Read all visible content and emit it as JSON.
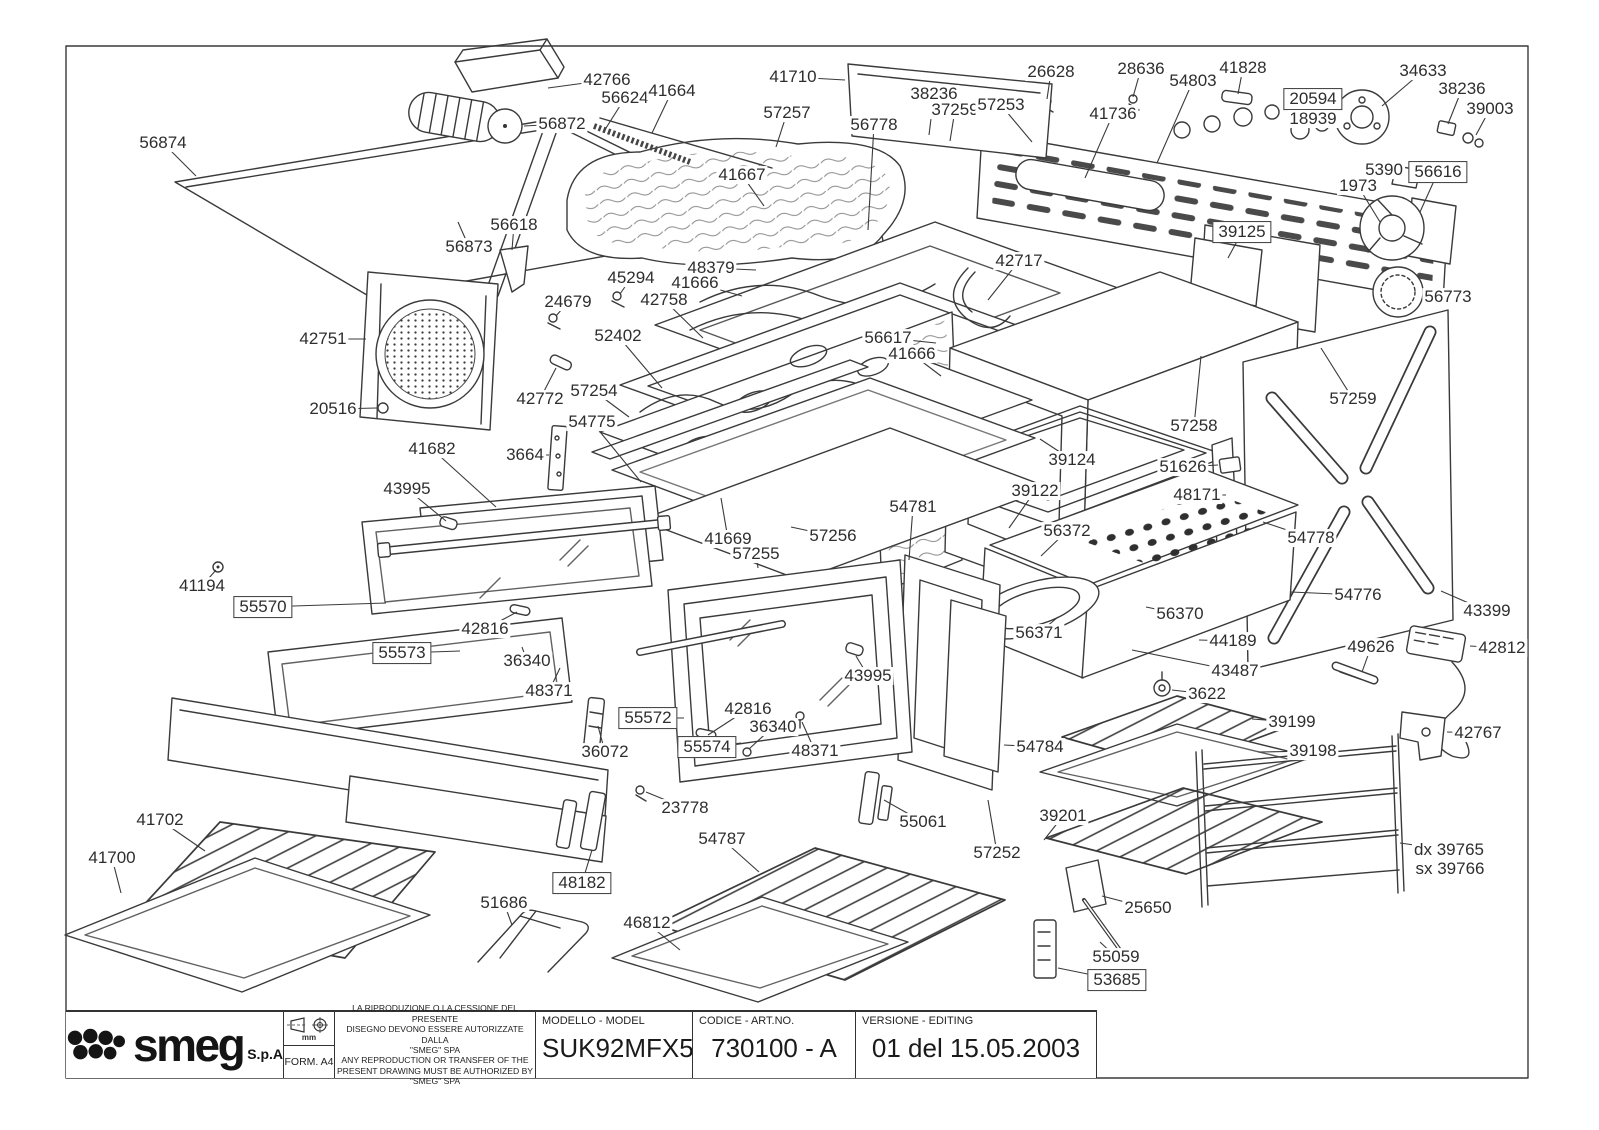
{
  "document": {
    "kind": "exploded parts diagram",
    "product": "oven"
  },
  "title_block": {
    "manufacturer": "smeg",
    "company_suffix": "S.p.A",
    "units_label": "mm",
    "form_label": "FORM. A4",
    "legal_lines": [
      "LA RIPRODUZIONE O LA CESSIONE DEL PRESENTE",
      "DISEGNO DEVONO ESSERE AUTORIZZATE DALLA",
      "\"SMEG\" SPA",
      "ANY REPRODUCTION OR TRANSFER OF THE",
      "PRESENT DRAWING MUST BE AUTHORIZED BY",
      "\"SMEG\" SPA"
    ],
    "model": {
      "label": "MODELLO - MODEL",
      "value": "SUK92MFX5"
    },
    "code": {
      "label": "CODICE - ART.NO.",
      "value": "730100 - A"
    },
    "version": {
      "label": "VERSIONE - EDITING",
      "value": "01 del 15.05.2003"
    }
  },
  "line_color": "#3a3a3a",
  "labels": [
    {
      "text": "42766",
      "x": 607,
      "y": 80,
      "l": [
        548,
        88
      ]
    },
    {
      "text": "56624",
      "x": 625,
      "y": 98,
      "l": [
        606,
        128
      ]
    },
    {
      "text": "41664",
      "x": 672,
      "y": 91,
      "l": [
        652,
        133
      ]
    },
    {
      "text": "56872",
      "x": 562,
      "y": 124,
      "l": [
        524,
        126
      ]
    },
    {
      "text": "56874",
      "x": 163,
      "y": 143,
      "l": [
        196,
        176
      ]
    },
    {
      "text": "56873",
      "x": 469,
      "y": 247,
      "l": [
        458,
        222
      ]
    },
    {
      "text": "56618",
      "x": 514,
      "y": 225,
      "l": [
        512,
        250
      ]
    },
    {
      "text": "41710",
      "x": 793,
      "y": 77,
      "l": [
        845,
        80
      ]
    },
    {
      "text": "57257",
      "x": 787,
      "y": 113,
      "l": [
        776,
        147
      ]
    },
    {
      "text": "41667",
      "x": 742,
      "y": 175,
      "l": [
        764,
        206
      ]
    },
    {
      "text": "56778",
      "x": 874,
      "y": 125,
      "l": [
        868,
        230
      ]
    },
    {
      "text": "38236",
      "x": 934,
      "y": 94,
      "l": [
        929,
        135
      ]
    },
    {
      "text": "37259",
      "x": 955,
      "y": 110,
      "l": [
        950,
        141
      ]
    },
    {
      "text": "57253",
      "x": 1001,
      "y": 105,
      "l": [
        1032,
        142
      ]
    },
    {
      "text": "26628",
      "x": 1051,
      "y": 72,
      "l": [
        1047,
        99
      ]
    },
    {
      "text": "28636",
      "x": 1141,
      "y": 69,
      "l": [
        1133,
        97
      ]
    },
    {
      "text": "54803",
      "x": 1193,
      "y": 81,
      "l": [
        1157,
        163
      ]
    },
    {
      "text": "41828",
      "x": 1243,
      "y": 68,
      "l": [
        1238,
        94
      ]
    },
    {
      "text": "41736",
      "x": 1113,
      "y": 114,
      "l": [
        1085,
        178
      ]
    },
    {
      "text": "34633",
      "x": 1423,
      "y": 71,
      "l": [
        1382,
        106
      ]
    },
    {
      "text": "20594",
      "x": 1313,
      "y": 99,
      "boxed": true,
      "l": [
        1303,
        125
      ]
    },
    {
      "text": "18939",
      "x": 1313,
      "y": 119
    },
    {
      "text": "38236",
      "x": 1462,
      "y": 89,
      "l": [
        1448,
        124
      ]
    },
    {
      "text": "39003",
      "x": 1490,
      "y": 109,
      "l": [
        1476,
        135
      ]
    },
    {
      "text": "5390",
      "x": 1384,
      "y": 170,
      "l": [
        1404,
        172
      ]
    },
    {
      "text": "56616",
      "x": 1438,
      "y": 172,
      "boxed": true,
      "l": [
        1420,
        212
      ]
    },
    {
      "text": "1973",
      "x": 1358,
      "y": 186,
      "l": [
        1380,
        222
      ]
    },
    {
      "text": "39125",
      "x": 1242,
      "y": 232,
      "boxed": true,
      "l": [
        1228,
        258
      ]
    },
    {
      "text": "56773",
      "x": 1448,
      "y": 297,
      "l": [
        1423,
        293
      ]
    },
    {
      "text": "42717",
      "x": 1019,
      "y": 261,
      "l": [
        988,
        300
      ]
    },
    {
      "text": "48379",
      "x": 711,
      "y": 268,
      "l": [
        756,
        270
      ]
    },
    {
      "text": "41666",
      "x": 695,
      "y": 283,
      "l": [
        742,
        296
      ]
    },
    {
      "text": "45294",
      "x": 631,
      "y": 278,
      "l": [
        620,
        294
      ]
    },
    {
      "text": "42758",
      "x": 664,
      "y": 300,
      "l": [
        703,
        338
      ]
    },
    {
      "text": "24679",
      "x": 568,
      "y": 302,
      "l": [
        556,
        316
      ]
    },
    {
      "text": "52402",
      "x": 618,
      "y": 336,
      "l": [
        662,
        388
      ]
    },
    {
      "text": "42751",
      "x": 323,
      "y": 339,
      "l": [
        366,
        339
      ]
    },
    {
      "text": "20516",
      "x": 333,
      "y": 409,
      "l": [
        377,
        408
      ]
    },
    {
      "text": "42772",
      "x": 540,
      "y": 399,
      "l": [
        556,
        368
      ]
    },
    {
      "text": "57254",
      "x": 594,
      "y": 391,
      "l": [
        629,
        417
      ]
    },
    {
      "text": "54775",
      "x": 592,
      "y": 422,
      "l": [
        641,
        482
      ]
    },
    {
      "text": "3664",
      "x": 525,
      "y": 455,
      "l": [
        549,
        455
      ]
    },
    {
      "text": "41682",
      "x": 432,
      "y": 449,
      "l": [
        496,
        507
      ]
    },
    {
      "text": "43995",
      "x": 407,
      "y": 489,
      "l": [
        446,
        521
      ]
    },
    {
      "text": "41194",
      "x": 202,
      "y": 586,
      "l": [
        216,
        570
      ]
    },
    {
      "text": "55570",
      "x": 263,
      "y": 607,
      "boxed": true,
      "l": [
        386,
        603
      ]
    },
    {
      "text": "42816",
      "x": 485,
      "y": 629,
      "l": [
        517,
        612
      ]
    },
    {
      "text": "55573",
      "x": 402,
      "y": 653,
      "boxed": true,
      "l": [
        460,
        651
      ]
    },
    {
      "text": "36340",
      "x": 527,
      "y": 661,
      "l": [
        522,
        647
      ]
    },
    {
      "text": "48371",
      "x": 549,
      "y": 691,
      "l": [
        560,
        668
      ]
    },
    {
      "text": "56617",
      "x": 888,
      "y": 338,
      "l": [
        936,
        343
      ]
    },
    {
      "text": "41666",
      "x": 912,
      "y": 354,
      "l": [
        941,
        376
      ]
    },
    {
      "text": "39124",
      "x": 1072,
      "y": 460,
      "l": [
        1040,
        439
      ]
    },
    {
      "text": "57258",
      "x": 1194,
      "y": 426,
      "l": [
        1201,
        356
      ]
    },
    {
      "text": "51626",
      "x": 1183,
      "y": 467,
      "l": [
        1218,
        465
      ]
    },
    {
      "text": "48171",
      "x": 1197,
      "y": 495,
      "l": [
        1226,
        495
      ]
    },
    {
      "text": "57259",
      "x": 1353,
      "y": 399,
      "l": [
        1321,
        348
      ]
    },
    {
      "text": "54778",
      "x": 1311,
      "y": 538,
      "l": [
        1263,
        522
      ]
    },
    {
      "text": "54776",
      "x": 1358,
      "y": 595,
      "l": [
        1291,
        592
      ]
    },
    {
      "text": "43399",
      "x": 1487,
      "y": 611,
      "l": [
        1441,
        591
      ]
    },
    {
      "text": "41669",
      "x": 728,
      "y": 539,
      "l": [
        721,
        498
      ]
    },
    {
      "text": "57256",
      "x": 833,
      "y": 536,
      "l": [
        791,
        527
      ]
    },
    {
      "text": "57255",
      "x": 756,
      "y": 554,
      "l": [
        758,
        568
      ]
    },
    {
      "text": "54781",
      "x": 913,
      "y": 507,
      "l": [
        909,
        560
      ]
    },
    {
      "text": "39122",
      "x": 1035,
      "y": 491,
      "l": [
        1009,
        528
      ]
    },
    {
      "text": "56372",
      "x": 1067,
      "y": 531,
      "l": [
        1041,
        556
      ]
    },
    {
      "text": "56370",
      "x": 1180,
      "y": 614,
      "l": [
        1146,
        607
      ]
    },
    {
      "text": "56371",
      "x": 1039,
      "y": 633,
      "l": [
        1058,
        617
      ]
    },
    {
      "text": "44189",
      "x": 1233,
      "y": 641,
      "l": [
        1199,
        640
      ]
    },
    {
      "text": "43487",
      "x": 1235,
      "y": 671,
      "l": [
        1132,
        650
      ]
    },
    {
      "text": "3622",
      "x": 1207,
      "y": 694,
      "l": [
        1172,
        690
      ]
    },
    {
      "text": "49626",
      "x": 1371,
      "y": 647,
      "l": [
        1362,
        672
      ]
    },
    {
      "text": "42812",
      "x": 1502,
      "y": 648,
      "l": [
        1470,
        646
      ]
    },
    {
      "text": "42767",
      "x": 1478,
      "y": 733,
      "l": [
        1447,
        732
      ]
    },
    {
      "text": "39199",
      "x": 1292,
      "y": 722,
      "l": [
        1252,
        719
      ]
    },
    {
      "text": "39198",
      "x": 1313,
      "y": 751,
      "l": [
        1258,
        752
      ]
    },
    {
      "text": "54784",
      "x": 1040,
      "y": 747,
      "l": [
        1004,
        745
      ]
    },
    {
      "text": "36072",
      "x": 605,
      "y": 752,
      "l": [
        598,
        726
      ]
    },
    {
      "text": "55572",
      "x": 648,
      "y": 718,
      "boxed": true,
      "l": [
        684,
        718
      ]
    },
    {
      "text": "42816",
      "x": 748,
      "y": 709,
      "l": [
        708,
        735
      ]
    },
    {
      "text": "36340",
      "x": 773,
      "y": 727,
      "l": [
        749,
        749
      ]
    },
    {
      "text": "55574",
      "x": 707,
      "y": 747,
      "boxed": true,
      "l": [
        741,
        743
      ]
    },
    {
      "text": "48371",
      "x": 815,
      "y": 751,
      "l": [
        802,
        722
      ]
    },
    {
      "text": "43995",
      "x": 868,
      "y": 676,
      "l": [
        856,
        656
      ]
    },
    {
      "text": "23778",
      "x": 685,
      "y": 808,
      "l": [
        646,
        792
      ]
    },
    {
      "text": "48182",
      "x": 582,
      "y": 883,
      "boxed": true,
      "l": [
        592,
        850
      ]
    },
    {
      "text": "41702",
      "x": 160,
      "y": 820,
      "l": [
        205,
        851
      ]
    },
    {
      "text": "41700",
      "x": 112,
      "y": 858,
      "l": [
        121,
        893
      ]
    },
    {
      "text": "51686",
      "x": 504,
      "y": 903,
      "l": [
        512,
        925
      ]
    },
    {
      "text": "54787",
      "x": 722,
      "y": 839,
      "l": [
        759,
        872
      ]
    },
    {
      "text": "46812",
      "x": 647,
      "y": 923,
      "l": [
        680,
        950
      ]
    },
    {
      "text": "55061",
      "x": 923,
      "y": 822,
      "l": [
        884,
        800
      ]
    },
    {
      "text": "57252",
      "x": 997,
      "y": 853,
      "l": [
        988,
        800
      ]
    },
    {
      "text": "39201",
      "x": 1063,
      "y": 816,
      "l": [
        1044,
        840
      ]
    },
    {
      "text": "25650",
      "x": 1148,
      "y": 908,
      "l": [
        1102,
        896
      ]
    },
    {
      "text": "55059",
      "x": 1116,
      "y": 957,
      "l": [
        1100,
        942
      ]
    },
    {
      "text": "53685",
      "x": 1117,
      "y": 980,
      "boxed": true,
      "l": [
        1058,
        968
      ]
    },
    {
      "text": "dx 39765",
      "x": 1449,
      "y": 850,
      "l": [
        1400,
        843
      ]
    },
    {
      "text": "sx 39766",
      "x": 1450,
      "y": 869
    }
  ]
}
